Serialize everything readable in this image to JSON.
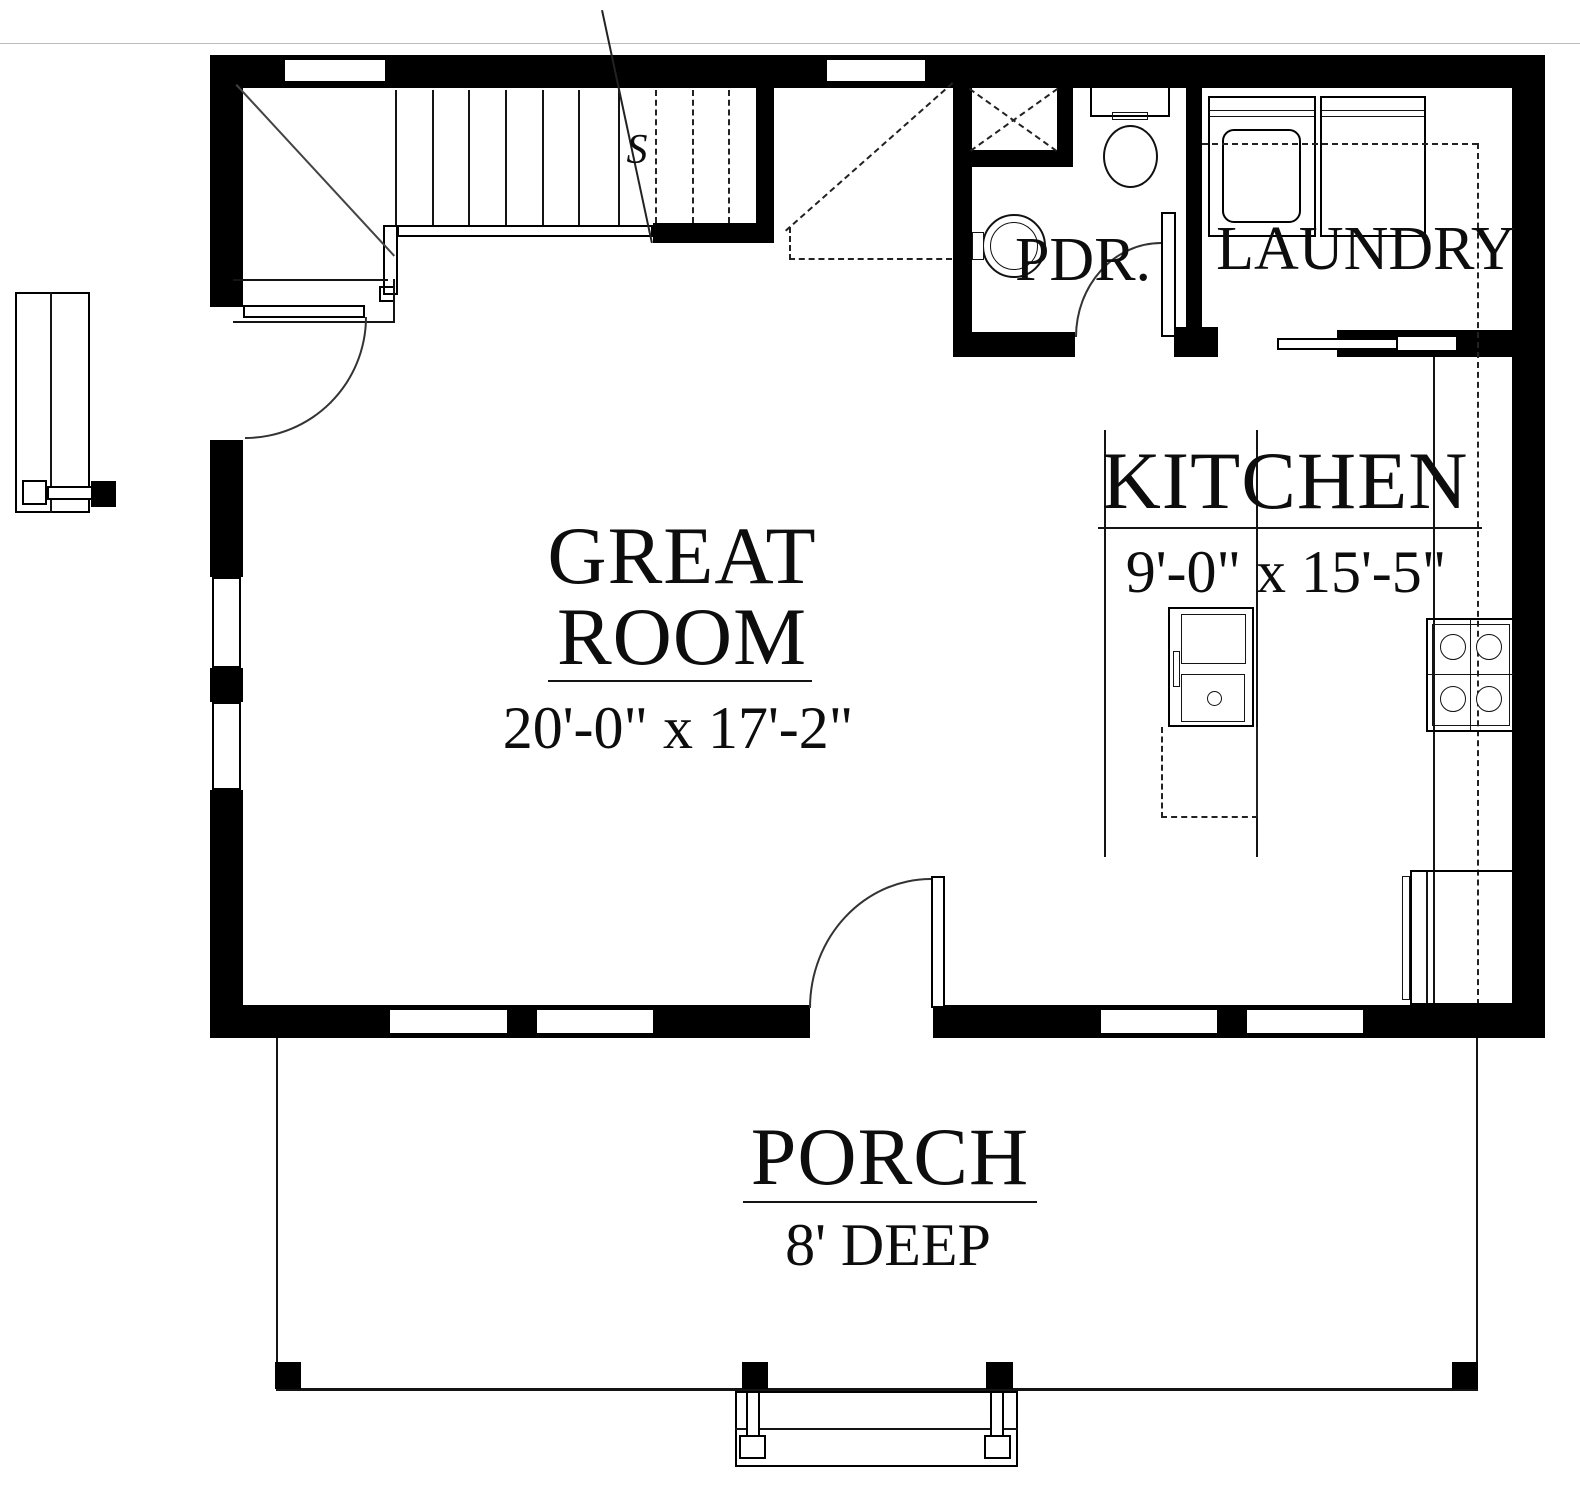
{
  "rooms": {
    "great_room": {
      "name_line1": "GREAT",
      "name_line2": "ROOM",
      "dims": "20'-0\" x 17'-2\""
    },
    "kitchen": {
      "name": "KITCHEN",
      "dims": "9'-0\" x 15'-5\""
    },
    "porch": {
      "name": "PORCH",
      "dims": "8' DEEP"
    },
    "powder_room": {
      "name": "PDR."
    },
    "laundry": {
      "name": "LAUNDRY"
    }
  },
  "stairs": {
    "section_marker": "S"
  },
  "colors": {
    "wall": "#000000",
    "line": "#141414",
    "background": "#ffffff"
  }
}
